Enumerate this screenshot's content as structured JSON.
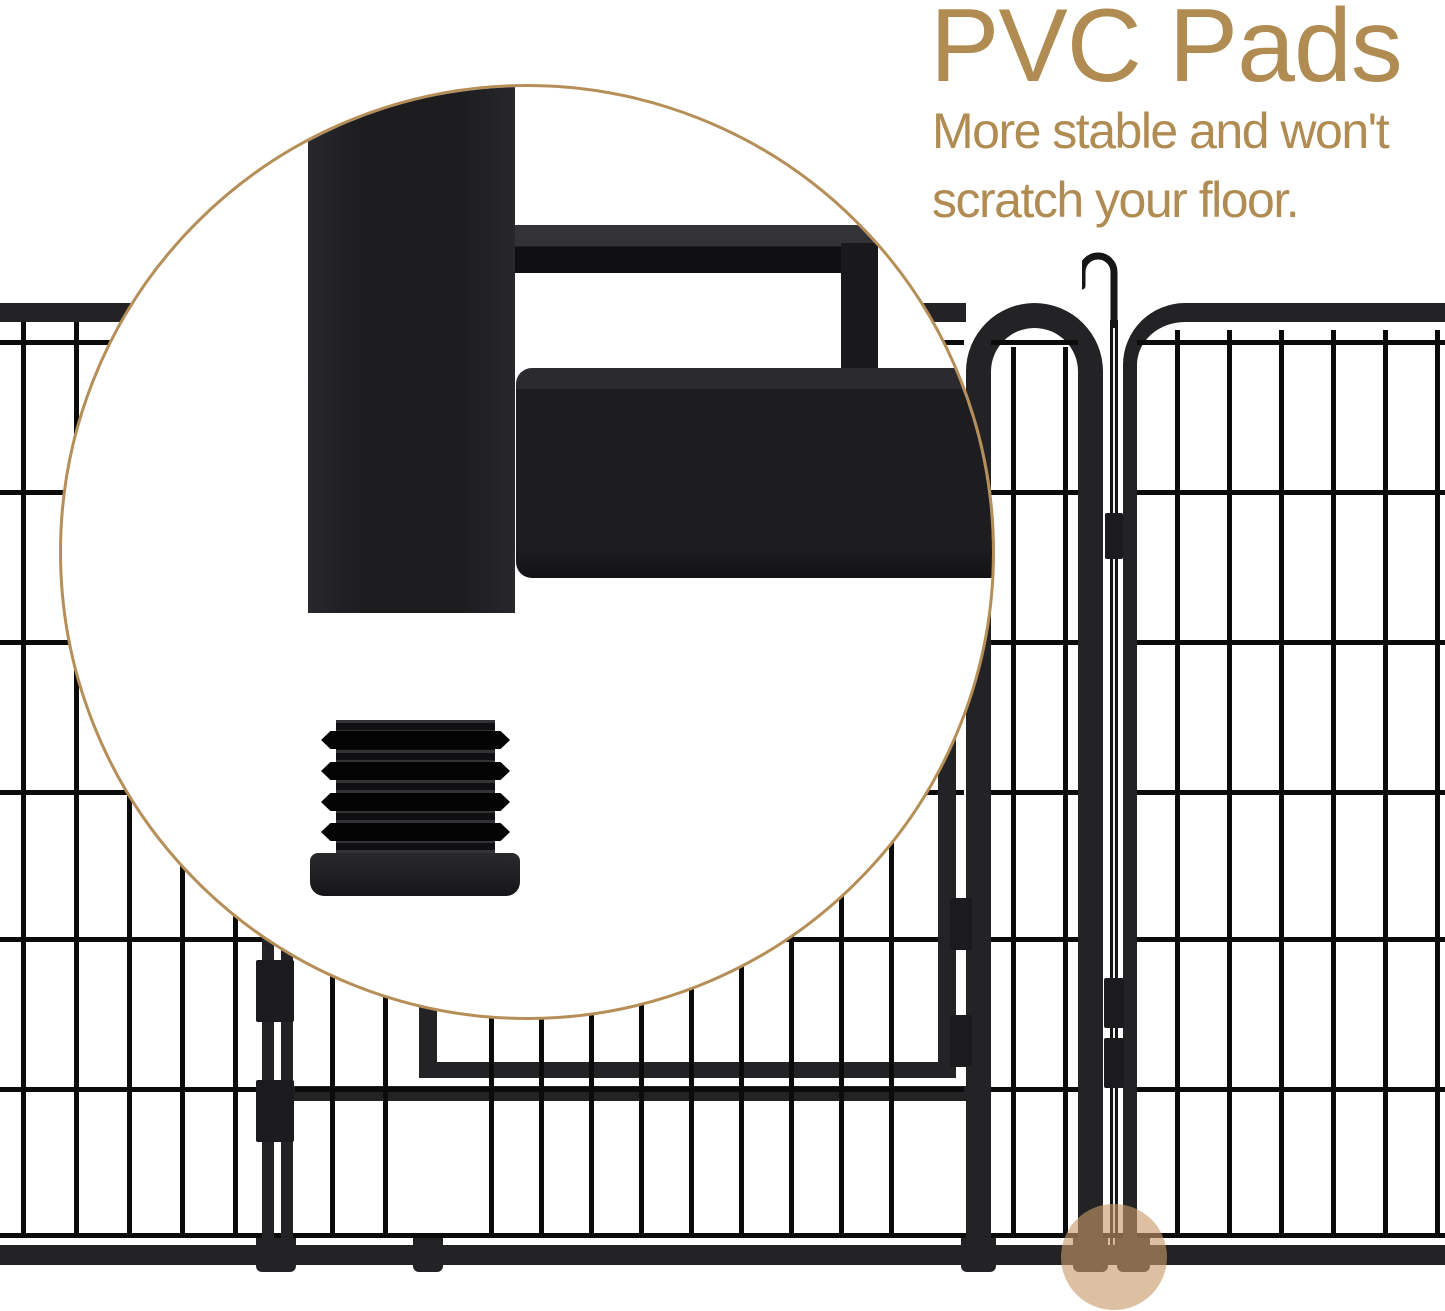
{
  "callout": {
    "title": "PVC Pads",
    "line1": "More stable and won't",
    "line2": "scratch your floor.",
    "text_color": "#b18c52"
  },
  "magnifier": {
    "border_color": "#b68e58"
  },
  "highlight": {
    "color": "#c79a68"
  },
  "fence": {
    "frame_color": "#232326",
    "wire_color": "#0b0b0c"
  }
}
